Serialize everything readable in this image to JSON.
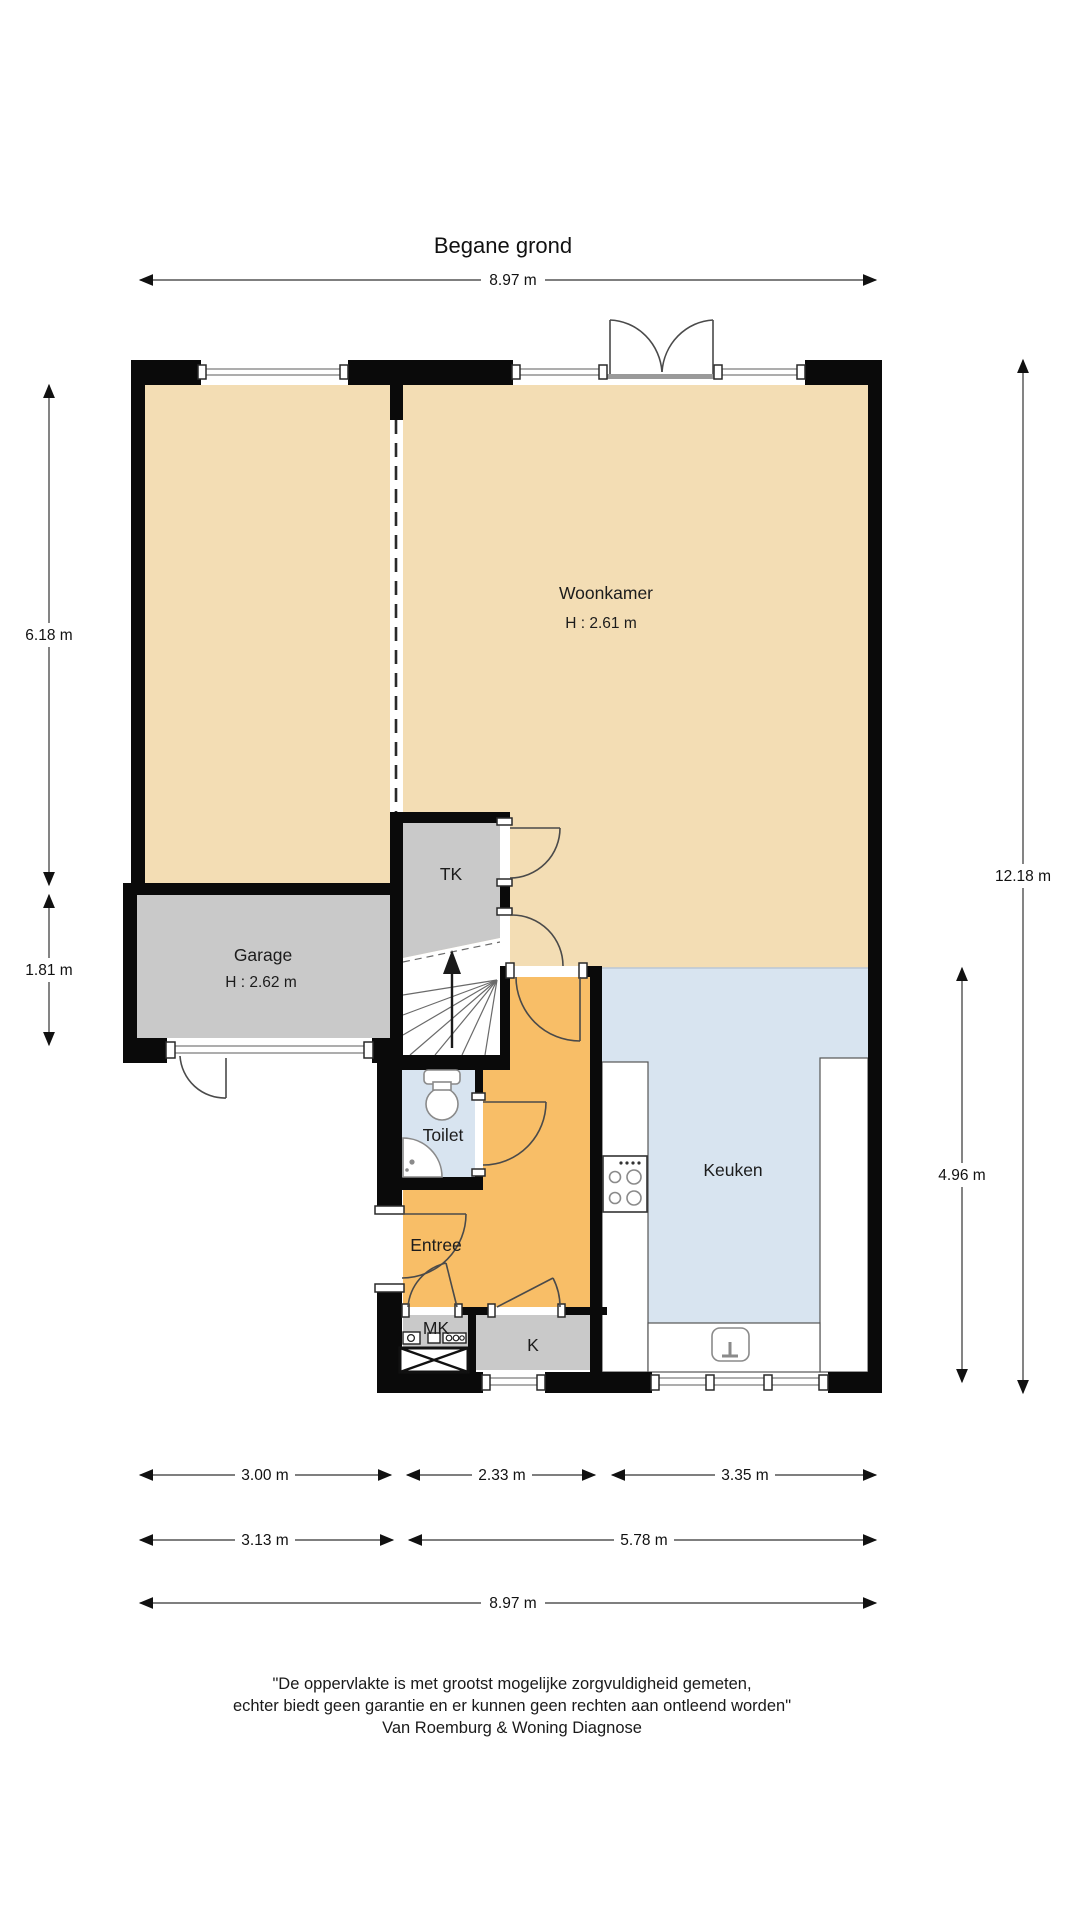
{
  "title": "Begane grond",
  "rooms": {
    "woonkamer": {
      "label": "Woonkamer",
      "ceiling": "H : 2.61 m"
    },
    "garage": {
      "label": "Garage",
      "ceiling": "H : 2.62 m"
    },
    "tk": {
      "label": "TK"
    },
    "toilet": {
      "label": "Toilet"
    },
    "entree": {
      "label": "Entree"
    },
    "mk": {
      "label": "MK"
    },
    "k": {
      "label": "K"
    },
    "keuken": {
      "label": "Keuken"
    }
  },
  "dimensions": {
    "top_total": "8.97 m",
    "left_upper": "6.18 m",
    "left_lower": "1.81 m",
    "right_total": "12.18 m",
    "right_inner": "4.96 m",
    "bottom_row1": [
      "3.00 m",
      "2.33 m",
      "3.35 m"
    ],
    "bottom_row2": [
      "3.13 m",
      "5.78 m"
    ],
    "bottom_total": "8.97 m"
  },
  "disclaimer": {
    "line1": "\"De oppervlakte is met grootst mogelijke zorgvuldigheid gemeten,",
    "line2": "echter biedt geen garantie en er kunnen geen rechten aan ontleend worden\"",
    "line3": "Van Roemburg & Woning Diagnose"
  },
  "fixtures": [
    "stairs-up-arrow",
    "toilet",
    "corner-sink",
    "stove",
    "kitchen-sink",
    "meter-cabinet"
  ],
  "colors": {
    "room_living": "#F3DDB4",
    "room_hall": "#F8BE67",
    "room_wet": "#D8E4F0",
    "room_utility": "#C9C9C9",
    "wall": "#0A0A0A"
  }
}
